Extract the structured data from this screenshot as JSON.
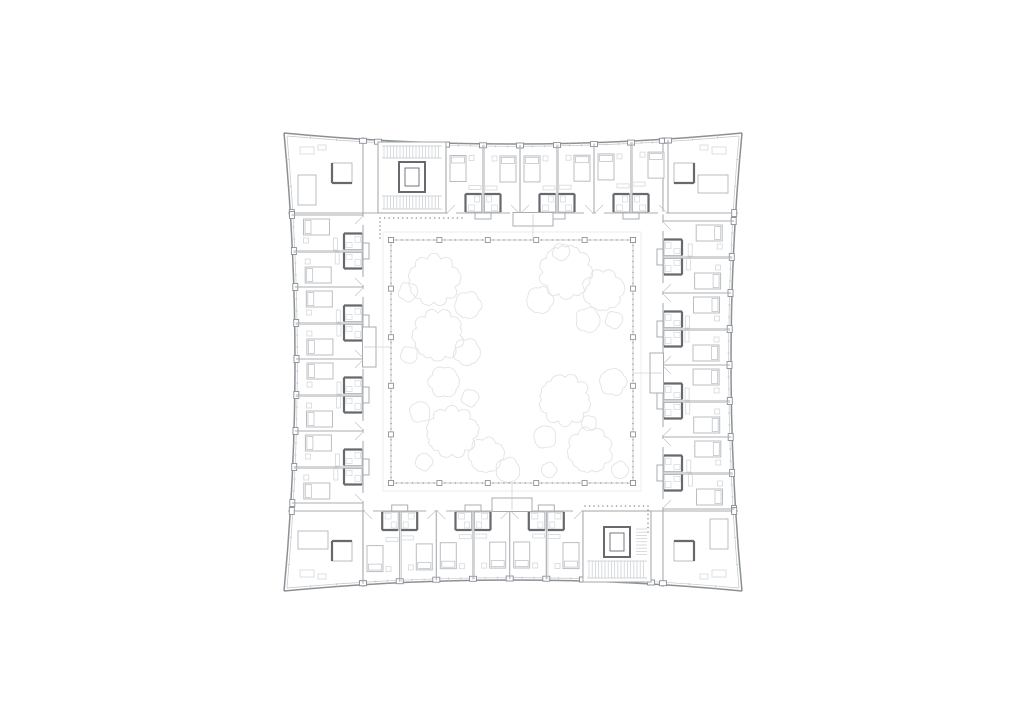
{
  "meta": {
    "description": "Architectural floor plan - square courtyard apartment building, typical floor, rooms around a planted central courtyard with two stair cores",
    "background": "#ffffff",
    "canvas": {
      "width": 1024,
      "height": 724
    }
  },
  "palette": {
    "facade": "#8b9095",
    "wall": "#a8acb1",
    "partition": "#c2c6ca",
    "dark": "#66696d",
    "furniture": "#b9bdc2",
    "furniture_light": "#d4d7da",
    "tree": "#e1e3e6",
    "court_line": "#bcc0c4",
    "paving": "#e9eaec",
    "dot": "#90959a",
    "hatch": "#c8ccd0"
  },
  "plan": {
    "outer": {
      "left": 284,
      "top": 133,
      "right": 742,
      "bottom": 591,
      "sag": 11
    },
    "ring": {
      "left": 363,
      "top": 213,
      "right": 663,
      "bottom": 511
    },
    "facade": {
      "notch_w": 7,
      "notch_d": 5,
      "tick_len": 3.5,
      "inner_offset": 3
    },
    "bands": [
      {
        "side": "top",
        "start": 446,
        "end": 668,
        "rooms": 6
      },
      {
        "side": "bottom",
        "start": 363,
        "end": 583,
        "rooms": 6
      },
      {
        "side": "left",
        "start": 215,
        "end": 503,
        "rooms": 8
      },
      {
        "side": "right",
        "start": 221,
        "end": 509,
        "rooms": 8
      }
    ],
    "facade_extra_notches": {
      "top": [
        363,
        378,
        446,
        663
      ],
      "bottom": [
        363,
        583,
        651,
        663
      ],
      "left": [
        213,
        511
      ],
      "right": [
        213,
        511
      ]
    },
    "room_module": {
      "bed": {
        "u": 4,
        "v": 12,
        "w": 16,
        "len": 26
      },
      "pillow": {
        "inset": 1.5,
        "len": 6
      },
      "bedside": {
        "u": 23,
        "v": 12,
        "size": 5
      },
      "desk": {
        "u": 23,
        "v": 42,
        "len": 12,
        "depth": 4
      },
      "bath": {
        "inset": 1.5,
        "size": 16,
        "depth": 18
      },
      "door": {
        "from": 2,
        "to": 10
      },
      "bump": {
        "half": 8,
        "depth": 6
      }
    },
    "cores": [
      {
        "side": "top",
        "x": 378,
        "y": 142,
        "w": 68,
        "h": 71,
        "elev_off": 20,
        "treads": [
          "above",
          "below"
        ]
      },
      {
        "side": "bottom",
        "x": 583,
        "y": 511,
        "w": 68,
        "h": 71,
        "elev_off": 16,
        "treads": [
          "below",
          "right"
        ]
      }
    ],
    "elevator": {
      "w": 26,
      "h": 30,
      "inner_inset": 6
    },
    "corners": [
      {
        "name": "top-left",
        "sx": 1,
        "sy": 1
      },
      {
        "name": "top-right",
        "sx": -1,
        "sy": 1
      },
      {
        "name": "bottom-left",
        "sx": 1,
        "sy": -1
      },
      {
        "name": "bottom-right",
        "sx": -1,
        "sy": -1
      }
    ],
    "corner_module": {
      "bed_off_u": 14,
      "bed_off_v": 42,
      "bed_w": 18,
      "bed_len": 30,
      "bath_off_u": 48,
      "bath_off_v": 30,
      "bath_size": 20,
      "table_off_u": 16,
      "table_off_v": 14,
      "table_w": 14,
      "table_d": 7,
      "ward_off_u": 34,
      "ward_off_v": 12,
      "ward_w": 8,
      "ward_d": 5
    },
    "vestibules": [
      {
        "side": "top",
        "center": 533
      },
      {
        "side": "bottom",
        "center": 512
      },
      {
        "side": "left",
        "center": 347
      },
      {
        "side": "right",
        "center": 373
      }
    ],
    "dotted": [
      {
        "x1": 380,
        "y1": 218,
        "x2": 462,
        "y2": 218
      },
      {
        "x1": 380,
        "y1": 222,
        "x2": 380,
        "y2": 238
      },
      {
        "x1": 585,
        "y1": 506,
        "x2": 648,
        "y2": 506
      },
      {
        "x1": 648,
        "y1": 510,
        "x2": 648,
        "y2": 532
      }
    ]
  },
  "courtyard": {
    "left": 391,
    "top": 240,
    "right": 633,
    "bottom": 483,
    "paving_offset": 8,
    "posts_per_side": 6,
    "post_size": 5,
    "dot_step": 5.4,
    "dot_r": 0.7,
    "tree_style": {
      "bump": 0.14,
      "stroke_w": 0.9
    }
  },
  "trees": [
    {
      "name": "northwest",
      "circles": [
        [
          434,
          280,
          26
        ],
        [
          468,
          305,
          14
        ],
        [
          408,
          292,
          10
        ],
        [
          438,
          335,
          26
        ],
        [
          467,
          352,
          14
        ],
        [
          409,
          355,
          9
        ],
        [
          444,
          382,
          16
        ]
      ]
    },
    {
      "name": "northeast",
      "circles": [
        [
          566,
          272,
          27
        ],
        [
          603,
          290,
          21
        ],
        [
          540,
          300,
          14
        ],
        [
          561,
          252,
          9
        ],
        [
          588,
          320,
          13
        ],
        [
          614,
          320,
          9
        ]
      ]
    },
    {
      "name": "southwest",
      "circles": [
        [
          420,
          412,
          11
        ],
        [
          452,
          432,
          26
        ],
        [
          486,
          455,
          18
        ],
        [
          424,
          462,
          9
        ],
        [
          470,
          398,
          9
        ],
        [
          508,
          470,
          13
        ]
      ]
    },
    {
      "name": "southeast",
      "circles": [
        [
          565,
          400,
          26
        ],
        [
          613,
          382,
          14
        ],
        [
          590,
          450,
          23
        ],
        [
          545,
          437,
          12
        ],
        [
          589,
          423,
          8
        ],
        [
          620,
          470,
          9
        ],
        [
          549,
          470,
          8
        ]
      ]
    }
  ]
}
